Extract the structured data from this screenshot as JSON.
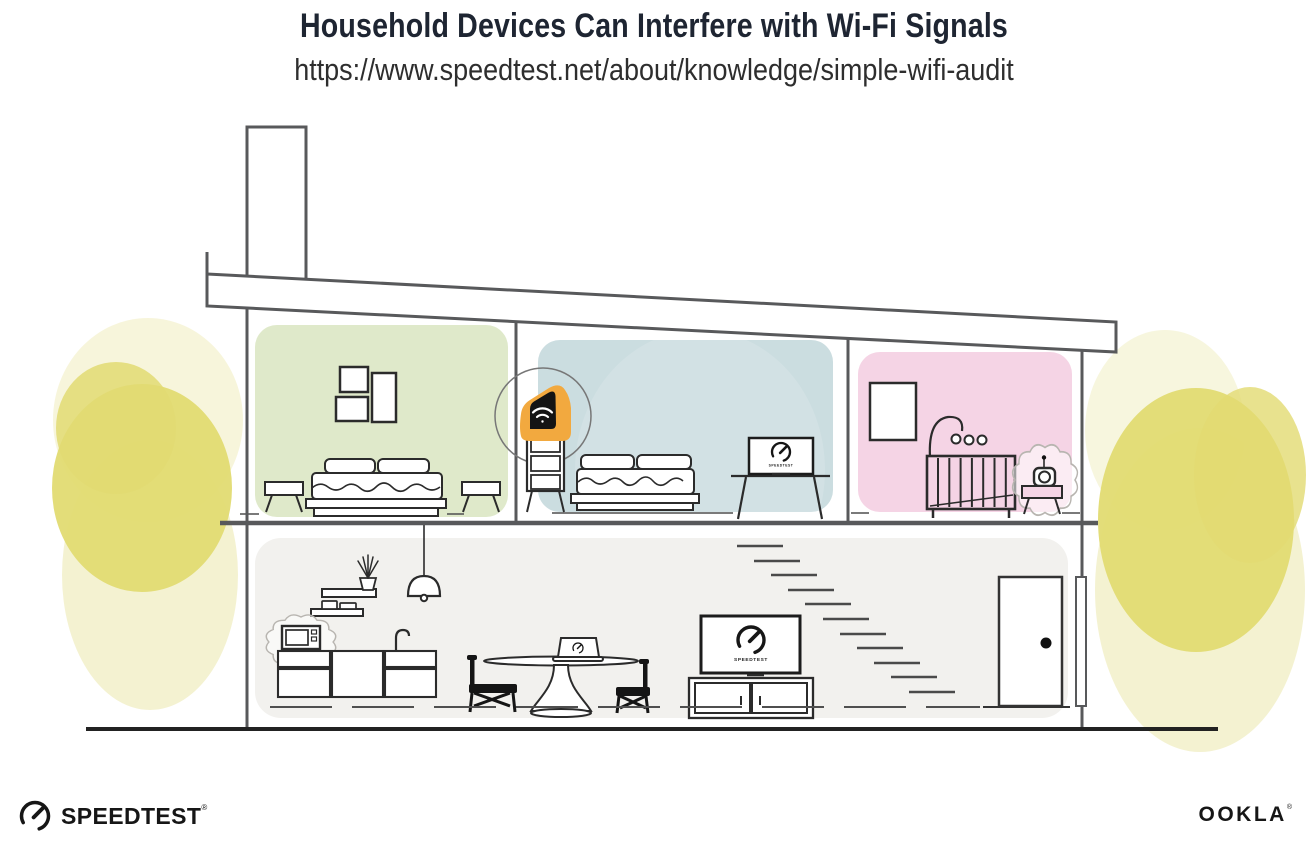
{
  "header": {
    "title": "Household Devices Can Interfere with Wi-Fi Signals",
    "url": "https://www.speedtest.net/about/knowledge/simple-wifi-audit"
  },
  "devices": {
    "bedroom_tv_label": "SPEEDTEST",
    "living_tv_label": "SPEEDTEST"
  },
  "branding": {
    "speedtest_wordmark": "SPEEDTEST",
    "speedtest_reg": "®",
    "ookla_wordmark": "OOKLA",
    "ookla_reg": "®"
  },
  "colors": {
    "title_text": "#1e2532",
    "url_text": "#2e2e2e",
    "accent_orange": "#f2a93f",
    "room_green": "#dfe9ca",
    "room_blue": "#cbdde0",
    "room_pink": "#f5d4e5",
    "room_lower": "#f2f1ee",
    "tree_core": "#e2db72",
    "tree_halo": "#f0edbe",
    "structure_line": "#58595b",
    "ink": "#1a1a1a"
  }
}
